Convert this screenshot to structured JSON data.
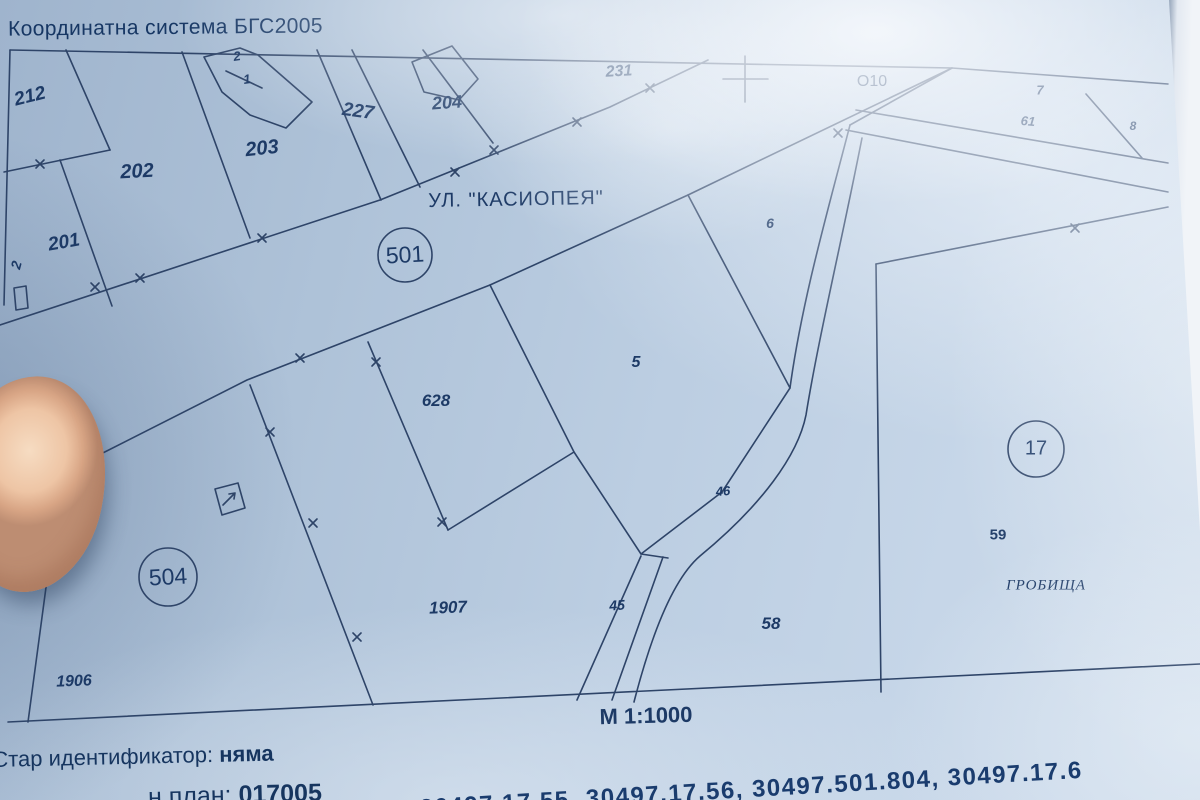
{
  "header": {
    "coordinate_system": "Координатна система БГС2005"
  },
  "map": {
    "street_label": "УЛ. \"КАСИОПЕЯ\"",
    "scale_label": "М 1:1000",
    "quarter_numbers": [
      "501",
      "504",
      "17"
    ],
    "labels": [
      {
        "text": "212",
        "x": 30,
        "y": 97,
        "fs": 19,
        "b": 1,
        "i": 1,
        "rot": -14
      },
      {
        "text": "202",
        "x": 137,
        "y": 172,
        "fs": 20,
        "b": 1,
        "i": 1,
        "rot": -3
      },
      {
        "text": "203",
        "x": 262,
        "y": 149,
        "fs": 20,
        "b": 1,
        "i": 1,
        "rot": -6
      },
      {
        "text": "227",
        "x": 358,
        "y": 112,
        "fs": 19,
        "b": 1,
        "i": 1,
        "rot": 8
      },
      {
        "text": "204",
        "x": 447,
        "y": 103,
        "fs": 18,
        "b": 1,
        "i": 1,
        "rot": -4
      },
      {
        "text": "231",
        "x": 619,
        "y": 72,
        "fs": 16,
        "b": 1,
        "i": 1,
        "rot": -3
      },
      {
        "text": "201",
        "x": 64,
        "y": 243,
        "fs": 19,
        "b": 1,
        "i": 1,
        "rot": -10
      },
      {
        "text": "2",
        "x": 16,
        "y": 265,
        "fs": 14,
        "b": 1,
        "i": 1,
        "rot": -75,
        "name": "edge-parcel-label"
      },
      {
        "text": "2",
        "x": 237,
        "y": 56,
        "fs": 13,
        "b": 1,
        "i": 1,
        "rot": -8,
        "name": "building-number-label"
      },
      {
        "text": "1",
        "x": 247,
        "y": 79,
        "fs": 13,
        "b": 1,
        "i": 1,
        "rot": -8,
        "name": "building-number-label"
      },
      {
        "text": "УЛ. \"КАСИОПЕЯ\"",
        "x": 516,
        "y": 200,
        "fs": 20,
        "rot": -1,
        "ls": 1,
        "name": "street-name-label"
      },
      {
        "text": "О10",
        "x": 872,
        "y": 82,
        "fs": 16,
        "name": "geodetic-point-label"
      },
      {
        "text": "7",
        "x": 1040,
        "y": 90,
        "fs": 13,
        "b": 1,
        "i": 1
      },
      {
        "text": "61",
        "x": 1028,
        "y": 121,
        "fs": 13,
        "b": 1,
        "i": 1,
        "rot": 5
      },
      {
        "text": "8",
        "x": 1133,
        "y": 126,
        "fs": 12,
        "b": 1,
        "i": 1
      },
      {
        "text": "6",
        "x": 770,
        "y": 223,
        "fs": 14,
        "b": 1,
        "i": 1
      },
      {
        "text": "5",
        "x": 636,
        "y": 363,
        "fs": 16,
        "b": 1,
        "i": 1
      },
      {
        "text": "628",
        "x": 436,
        "y": 401,
        "fs": 17,
        "b": 1,
        "i": 1
      },
      {
        "text": "46",
        "x": 723,
        "y": 491,
        "fs": 13,
        "b": 1,
        "i": 1,
        "rot": -4
      },
      {
        "text": "45",
        "x": 617,
        "y": 605,
        "fs": 14,
        "b": 1,
        "i": 1,
        "rot": -4
      },
      {
        "text": "58",
        "x": 771,
        "y": 624,
        "fs": 17,
        "b": 1,
        "i": 1
      },
      {
        "text": "59",
        "x": 998,
        "y": 535,
        "fs": 15,
        "b": 1
      },
      {
        "text": "ГРОБИЩА",
        "x": 1046,
        "y": 586,
        "fs": 15,
        "i": 1,
        "serif": 1,
        "ls": 1,
        "name": "cemetery-label"
      },
      {
        "text": "1907",
        "x": 448,
        "y": 608,
        "fs": 17,
        "b": 1,
        "i": 1,
        "rot": -2
      },
      {
        "text": "1906",
        "x": 74,
        "y": 682,
        "fs": 16,
        "b": 1,
        "i": 1,
        "rot": -2
      },
      {
        "text": "501",
        "x": 405,
        "y": 255,
        "fs": 23,
        "rot": -3,
        "name": "quarter-number-label"
      },
      {
        "text": "504",
        "x": 168,
        "y": 577,
        "fs": 23,
        "rot": -3,
        "name": "quarter-number-label"
      },
      {
        "text": "17",
        "x": 1036,
        "y": 449,
        "fs": 20,
        "name": "quarter-number-label"
      },
      {
        "text": "М 1:1000",
        "x": 646,
        "y": 716,
        "fs": 22,
        "b": 1,
        "rot": -1.5,
        "name": "map-scale-label"
      }
    ]
  },
  "footer": {
    "old_identifier_label": "Стар идентификатор:",
    "old_identifier_value": "няма",
    "plan_label": "н план:",
    "plan_value": "017005",
    "identifiers": "30497.17.55, 30497.17.56, 30497.501.804, 30497.17.6"
  }
}
